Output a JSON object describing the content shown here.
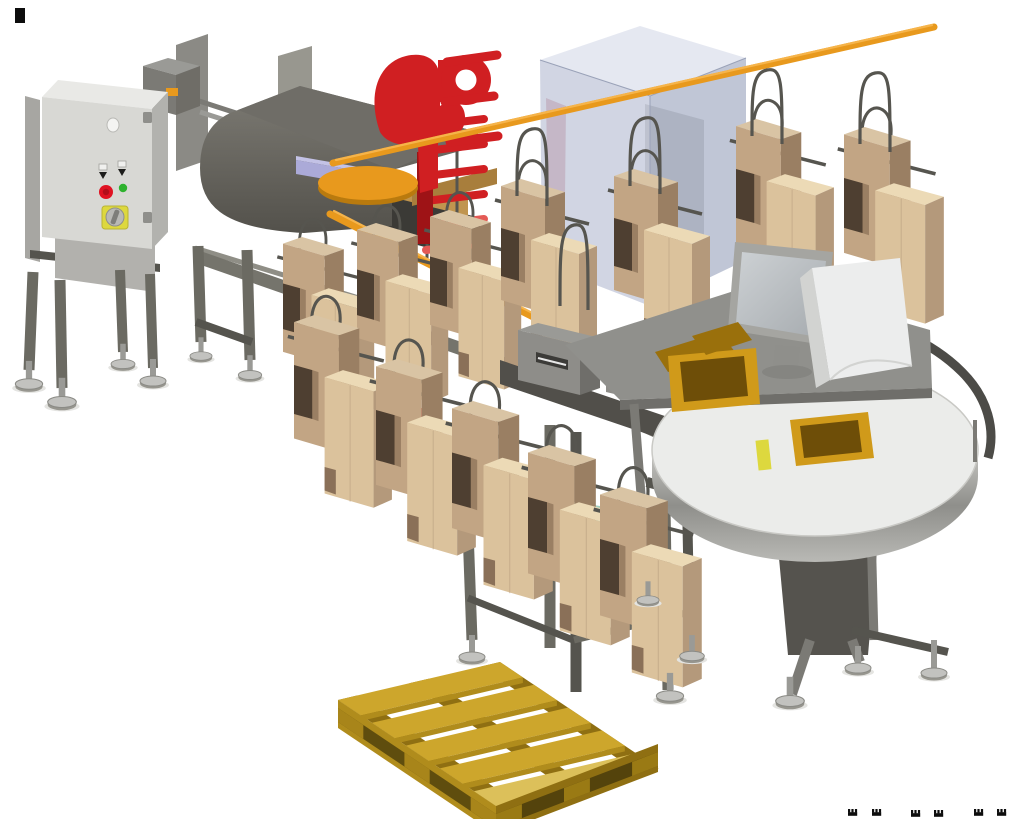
{
  "meta": {
    "description": "3D CAD rendering of a bag-in-box packaging line: infeed machine with control cabinet, red applicator bracket, orange overhead rails carrying wire hangers with cardboard cartons, translucent enclosure, packing desk with monitor, rotary accumulation table with trays, and a yellow wooden pallet.",
    "canvas": {
      "width": 1024,
      "height": 819
    }
  },
  "scene": {
    "palette": {
      "bg": "#ffffff",
      "ink": "#0d0d0d",
      "cab_front": "#d8d8d4",
      "cab_side": "#b2b2ae",
      "cab_top": "#e9e9e6",
      "cab_hinge": "#8f8f8b",
      "panel": "#a7a6a2",
      "sheet": "#8b8a85",
      "sheet2": "#98978f",
      "stand": "#b2b1ad",
      "leg": "#6b6a62",
      "leg_dk": "#55544e",
      "beam": "#75746c",
      "beam_lt": "#8f8e86",
      "steel": "#9a9a96",
      "steel_lt": "#c9c9c6",
      "steel_dk": "#7b7a75",
      "mach": "#6f6d67",
      "mach_dk": "#514f4a",
      "mach_deep": "#3b3a36",
      "wood": "#c0954f",
      "wood_dk": "#a87e3c",
      "peri": "#abaad8",
      "peri_lt": "#c3c2e6",
      "orange": "#e8991d",
      "orange_lt": "#f6b44a",
      "orange_dk": "#b97a0e",
      "red": "#d01f22",
      "red_dk": "#9e1316",
      "red_lt": "#e45a55",
      "red_ghost": "#b5525a",
      "glass_top": "#e2e6f0",
      "glass_l": "#c6cbdc",
      "glass_r": "#b0b8cc",
      "glass_edge": "#9aa2b8",
      "bxf": "#dbc29c",
      "bxt": "#ecdab6",
      "bxs": "#b4997b",
      "bxd": "#8a7058",
      "bxn": "#4e3f31",
      "bbf": "#c2a584",
      "bbt": "#d9c4a4",
      "bbs": "#9a7f63",
      "wire": "#56554f",
      "teal": "#7fb9a6",
      "teal_lt": "#a2cfc0",
      "teal_dk": "#5f9a89",
      "tbl_top": "#ebecea",
      "tbl_rim": "#a9a9a5",
      "tbl_rim_dk": "#848480",
      "rail_dk": "#4c4b47",
      "mon": "#a5a5a1",
      "mon_scr": "#c3c7ca",
      "white_p": "#eceded",
      "white_ps": "#d2d3d1",
      "tray": "#b8860f",
      "tray_dk": "#6e4e08",
      "tray_lt": "#d09a1a",
      "tray_md": "#9a700c",
      "pal": "#cda62c",
      "pal_lt": "#dcc05a",
      "pal_md": "#b08c1c",
      "pal_dk": "#8f6f12",
      "pal_gap": "#5f4d0e",
      "pal_gap2": "#54430c",
      "pal_blk": "#a8851a",
      "pal_blk2": "#9a7a14",
      "estop": "#e01222",
      "green": "#2eb22e",
      "yellow": "#ddd83e",
      "foot_disc": "#c2c2bf",
      "foot_under": "#97968f",
      "foot_edge": "#8a8a85",
      "shadow": "#e4e4e1"
    },
    "objects": [
      {
        "id": "control-cabinet",
        "label": "electrical control cabinet with e-stop, selector and main switch"
      },
      {
        "id": "infeed-machine",
        "label": "grey infeed machine with hood and wood deck"
      },
      {
        "id": "red-applicator",
        "label": "red applicator bracket with pegs and rungs"
      },
      {
        "id": "rotary-disc",
        "label": "orange rotary disc"
      },
      {
        "id": "overhead-rails",
        "label": "orange overhead hanger rails"
      },
      {
        "id": "glass-enclosure",
        "label": "translucent machine enclosure"
      },
      {
        "id": "carton-hangers",
        "label": "wire hangers carrying cardboard cartons"
      },
      {
        "id": "slotted-units",
        "label": "grey slotted control units"
      },
      {
        "id": "teal-bin",
        "label": "teal tote bin"
      },
      {
        "id": "packing-desk",
        "label": "inclined packing desk with monitor and deflector"
      },
      {
        "id": "rotary-table",
        "label": "rotary accumulation table with trays"
      },
      {
        "id": "wooden-pallet",
        "label": "yellow wooden pallet"
      },
      {
        "id": "leveling-feet",
        "label": "adjustable leveling feet"
      }
    ],
    "hangers": [
      {
        "transform": "translate(283,236) scale(0.95)"
      },
      {
        "transform": "translate(357,222) scale(0.95)"
      },
      {
        "transform": "translate(430,209) scale(0.95)"
      },
      {
        "transform": "translate(501,178) scale(1.0)"
      },
      {
        "transform": "translate(614,168) scale(1.0)"
      },
      {
        "transform": "translate(736,118) scale(1.02)"
      },
      {
        "transform": "translate(844,126) scale(1.04)"
      }
    ],
    "hangers_front": [
      {
        "transform": "translate(294,314) scale(1.02)"
      },
      {
        "transform": "translate(376,358) scale(1.04)"
      },
      {
        "transform": "translate(452,400) scale(1.05)"
      },
      {
        "transform": "translate(528,444) scale(1.06)"
      },
      {
        "transform": "translate(600,486) scale(1.06)"
      }
    ],
    "wire_paths": [
      {
        "d": "M517,196 C517,150 517,132 532,129 C547,126 547,142 547,206"
      },
      {
        "d": "M630,186 C630,140 630,121 645,118 C660,115 660,131 660,194"
      },
      {
        "d": "M752,136 C752,92 752,73 767,70 C782,67 782,83 782,144"
      },
      {
        "d": "M860,144 C860,96 860,76 875,73 C890,70 890,86 890,152"
      },
      {
        "d": "M560,306 C560,250 560,228 574,225 C588,222 588,240 588,310"
      }
    ],
    "feet": [
      {
        "transform": "translate(29,384) scale(1.05)"
      },
      {
        "transform": "translate(62,402) scale(1.1)"
      },
      {
        "transform": "translate(123,364) scale(0.92)"
      },
      {
        "transform": "translate(153,381) scale(1.0)"
      },
      {
        "transform": "translate(201,356) scale(0.85)"
      },
      {
        "transform": "translate(250,375) scale(0.9)"
      },
      {
        "transform": "translate(472,657) scale(1.0)"
      },
      {
        "transform": "translate(648,600) scale(0.85)"
      },
      {
        "transform": "translate(670,696) scale(1.05)"
      },
      {
        "transform": "translate(692,656) scale(0.95)"
      },
      {
        "transform": "translate(790,701) scale(1.1)"
      },
      {
        "transform": "translate(858,668) scale(1.0)"
      },
      {
        "transform": "translate(934,673) scale(1.0)"
      }
    ],
    "marks": {
      "top_left": {
        "x": 15,
        "y": 8,
        "w": 10,
        "h": 15
      },
      "bottom_right": [
        {
          "transform": "translate(848,809)"
        },
        {
          "transform": "translate(872,809)"
        },
        {
          "transform": "translate(911,810)"
        },
        {
          "transform": "translate(934,810)"
        },
        {
          "transform": "translate(974,809)"
        },
        {
          "transform": "translate(997,809)"
        }
      ]
    }
  }
}
